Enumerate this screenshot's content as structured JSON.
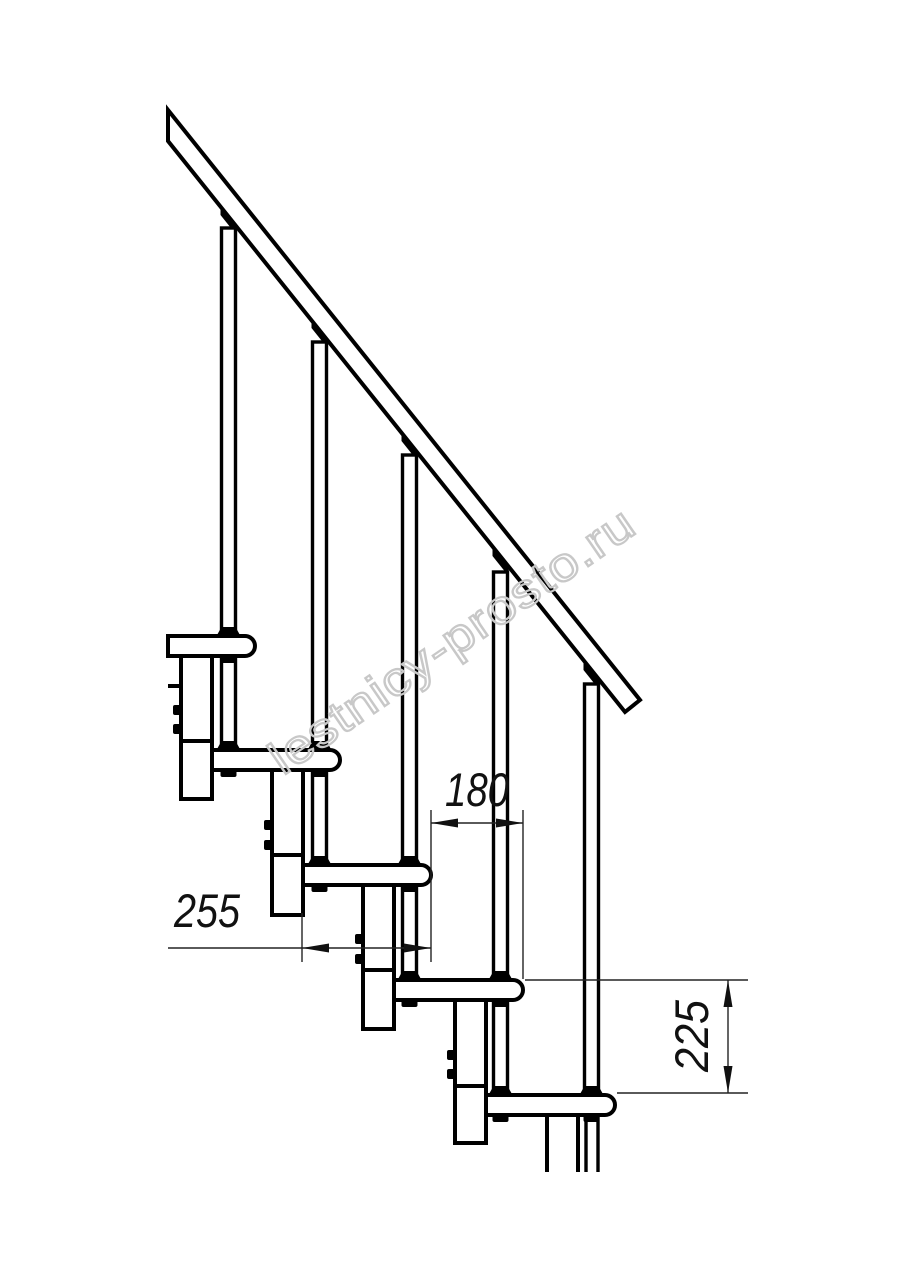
{
  "drawing": {
    "watermark": {
      "text": "lestnicy-prosto.ru",
      "color": "#c8c8c8"
    },
    "dimensions": {
      "step_run": {
        "value": "180"
      },
      "tread_depth": {
        "value": "255"
      },
      "step_rise": {
        "value": "225"
      }
    },
    "colors": {
      "line": "#000000",
      "dimension_line": "#232323",
      "background": "#ffffff"
    }
  }
}
